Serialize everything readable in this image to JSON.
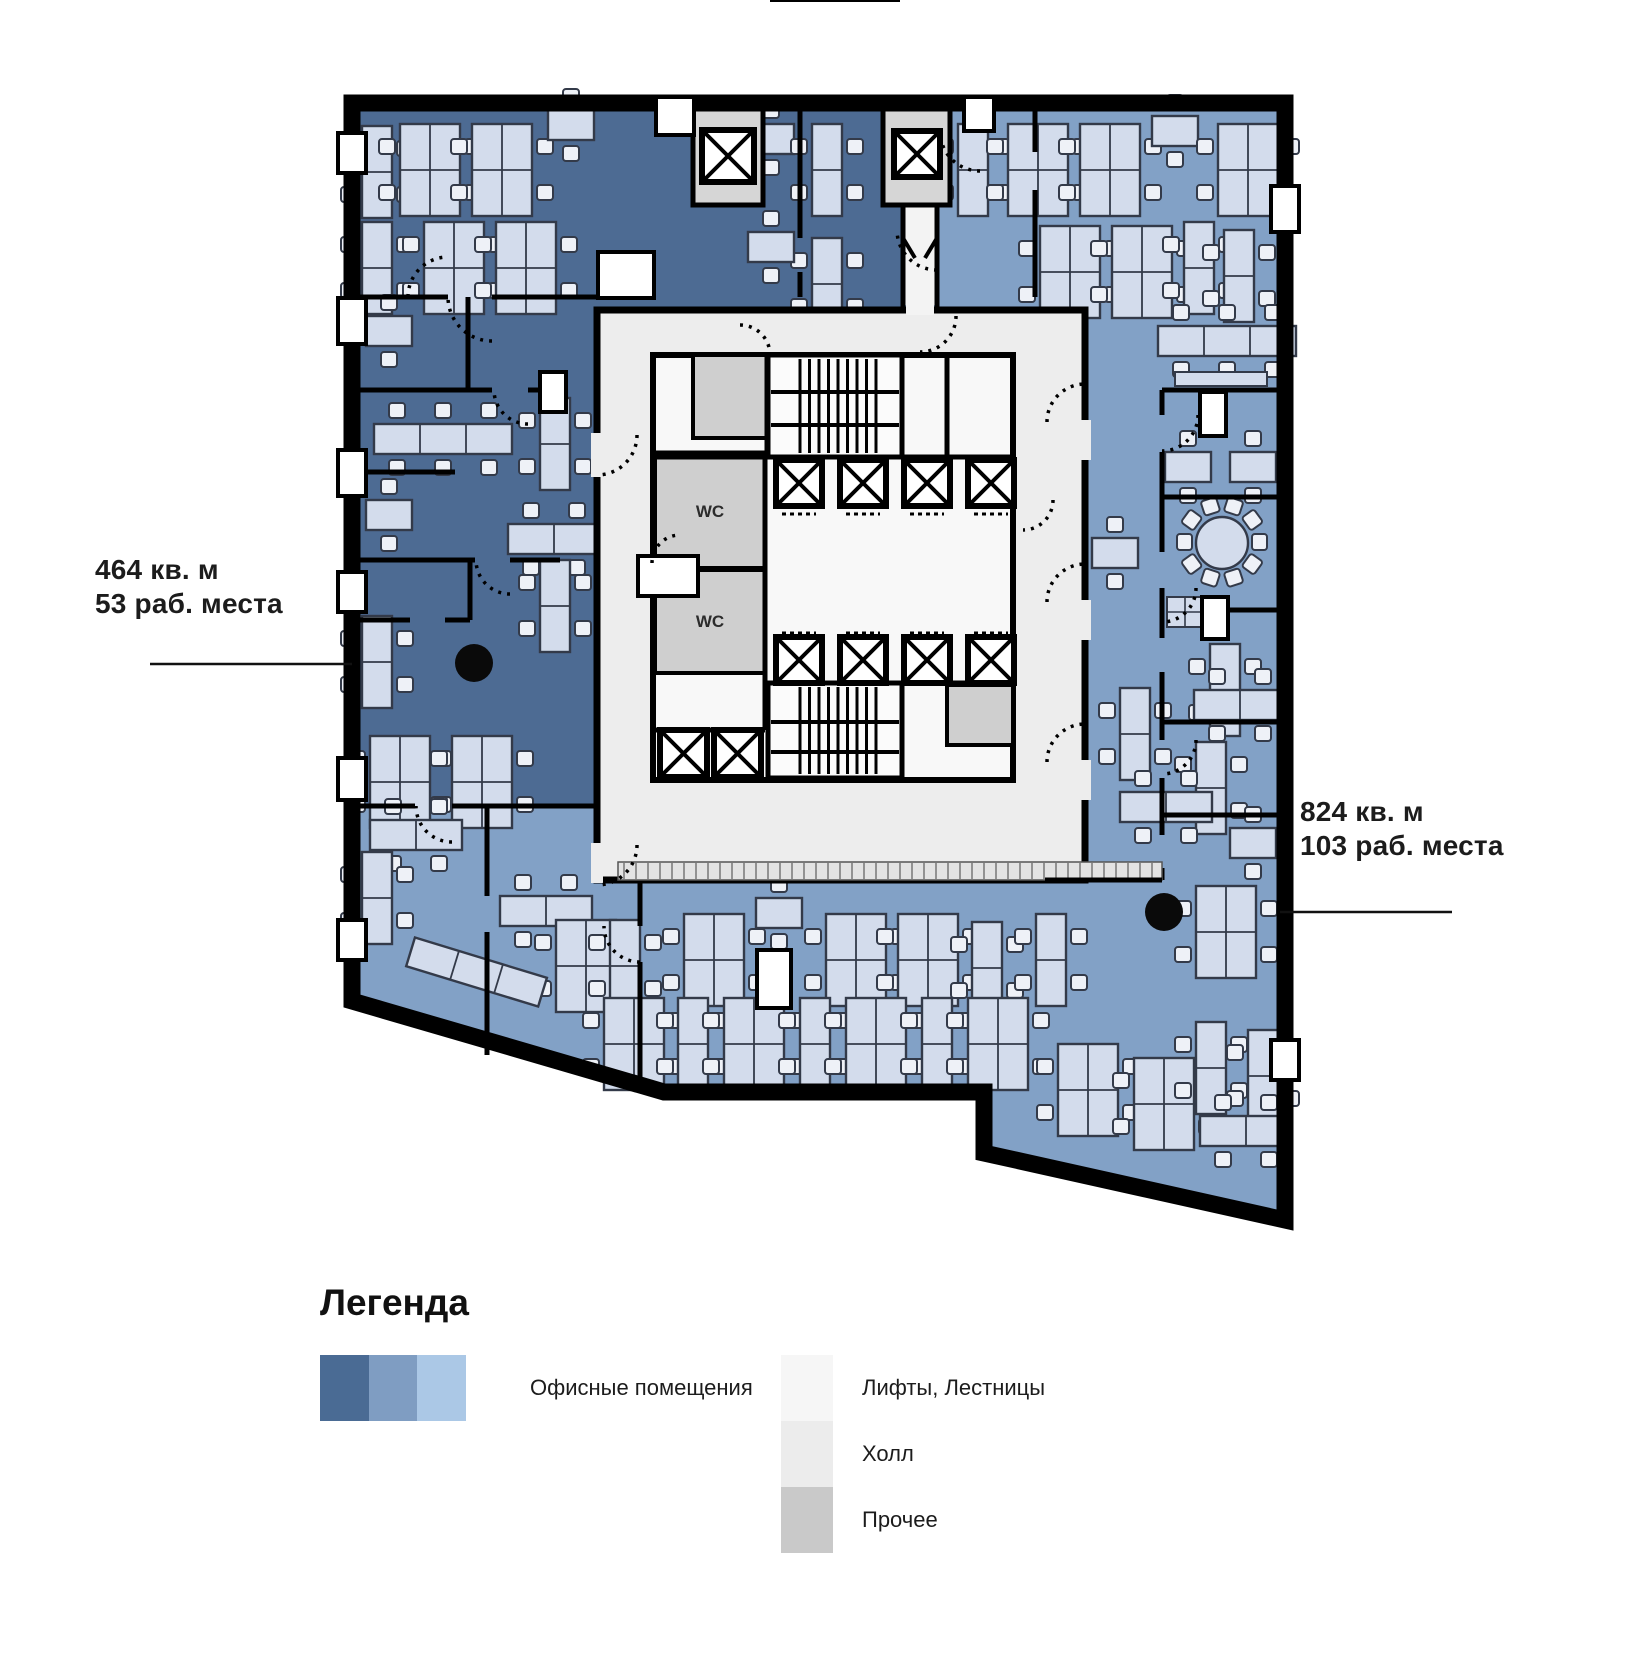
{
  "plan": {
    "wc_label": "WC"
  },
  "annotations": {
    "left": {
      "area": "464 кв. м",
      "seats": "53 раб. места"
    },
    "right": {
      "area": "824 кв. м",
      "seats": "103 раб. места"
    }
  },
  "legend": {
    "title": "Легенда",
    "office": {
      "label": "Офисные помещения",
      "colors": [
        "#4a6b94",
        "#7f9dc2",
        "#abc8e6"
      ]
    },
    "items": [
      {
        "label": "Лифты, Лестницы",
        "color": "#f6f6f6"
      },
      {
        "label": "Холл",
        "color": "#ececec"
      },
      {
        "label": "Прочее",
        "color": "#c9c9c9"
      }
    ]
  },
  "colors": {
    "zone_dark": "#4d6b93",
    "zone_medium": "#82a1c6",
    "core_hall": "#ededed",
    "lift_stairs": "#f8f8f8",
    "misc_gray": "#cfcfcf",
    "shaft_gray": "#d6d6d6",
    "wall": "#000000",
    "furniture_fill": "#d3dcec",
    "furniture_stroke": "#333a49",
    "chair_fill": "#eef1f7",
    "text": "#1c1c1c"
  }
}
